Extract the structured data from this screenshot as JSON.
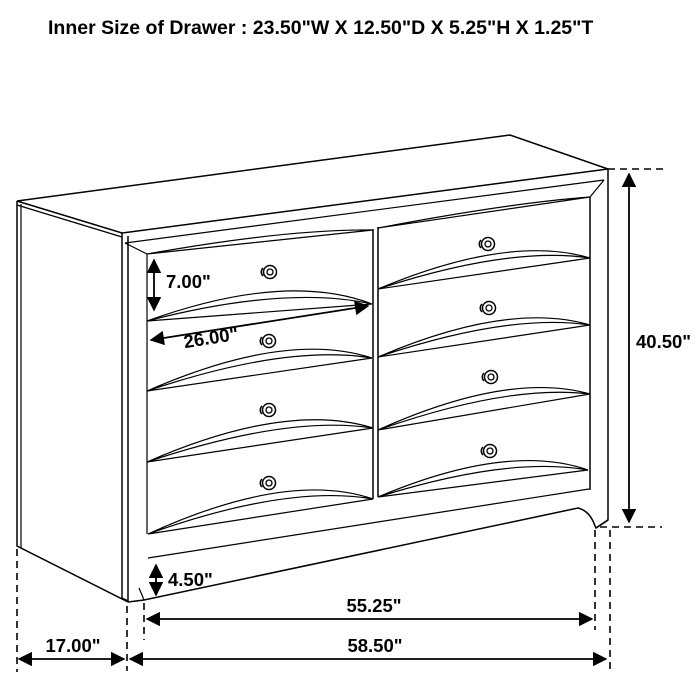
{
  "page": {
    "background": "#ffffff",
    "line_color": "#000000"
  },
  "title": "Inner Size of Drawer : 23.50\"W X 12.50\"D X 5.25\"H X 1.25\"T",
  "diagram": {
    "type": "furniture-dimension-line-drawing",
    "subject": "eight-drawer dresser, two columns of four drawers, shown in perspective",
    "knob_count": 8,
    "dimension_labels": {
      "drawer_front_height": "7.00\"",
      "drawer_front_width": "26.00\"",
      "overall_height": "40.50\"",
      "base_height": "4.50\"",
      "footprint_width": "55.25\"",
      "overall_width": "58.50\"",
      "side_depth": "17.00\""
    },
    "inner_drawer_size": {
      "width": "23.50\"",
      "depth": "12.50\"",
      "height": "5.25\"",
      "thickness": "1.25\""
    }
  }
}
